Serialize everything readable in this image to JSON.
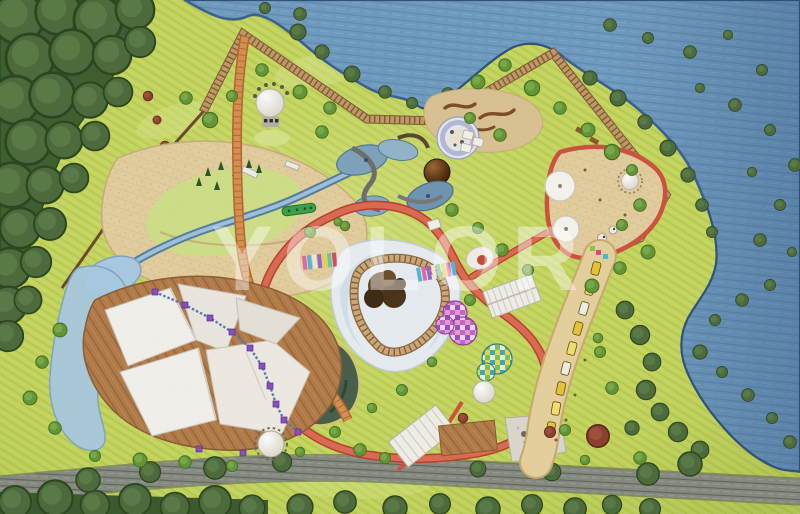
{
  "watermark": {
    "text": "YOLOR",
    "color": "#ffffff",
    "opacity": 0.42
  },
  "palette": {
    "grass": "#c5d75e",
    "grass_hatch": "#b2c648",
    "meadow_light": "#d6e487",
    "water": "#6f9cc1",
    "water_stroke": "#5d8bb2",
    "shoreline": "#2e527e",
    "forest": "#3d6030",
    "forest_dark": "#2d4a22",
    "road": "#868b82",
    "road_dark": "#5f665c",
    "sand": "#e4cf9f",
    "dune_brown": "#7d4e26",
    "boardwalk": "#c49a66",
    "boardwalk_tie": "#7d5a38",
    "path_red": "#dd6a52",
    "path_red_edge": "#b8402e",
    "path_orange": "#d89050",
    "pool_light_blue": "#a9cbe3",
    "pool_dark_green": "#47604b",
    "canopy_white": "#f4f2ee",
    "deck_wood": "#b27b49",
    "rope_purple": "#8a4fc0",
    "dome_pink": "#c468c8",
    "dome_teal": "#4aa8c0",
    "train_yellow": "#e8c536",
    "maple_red": "#8a4030"
  }
}
